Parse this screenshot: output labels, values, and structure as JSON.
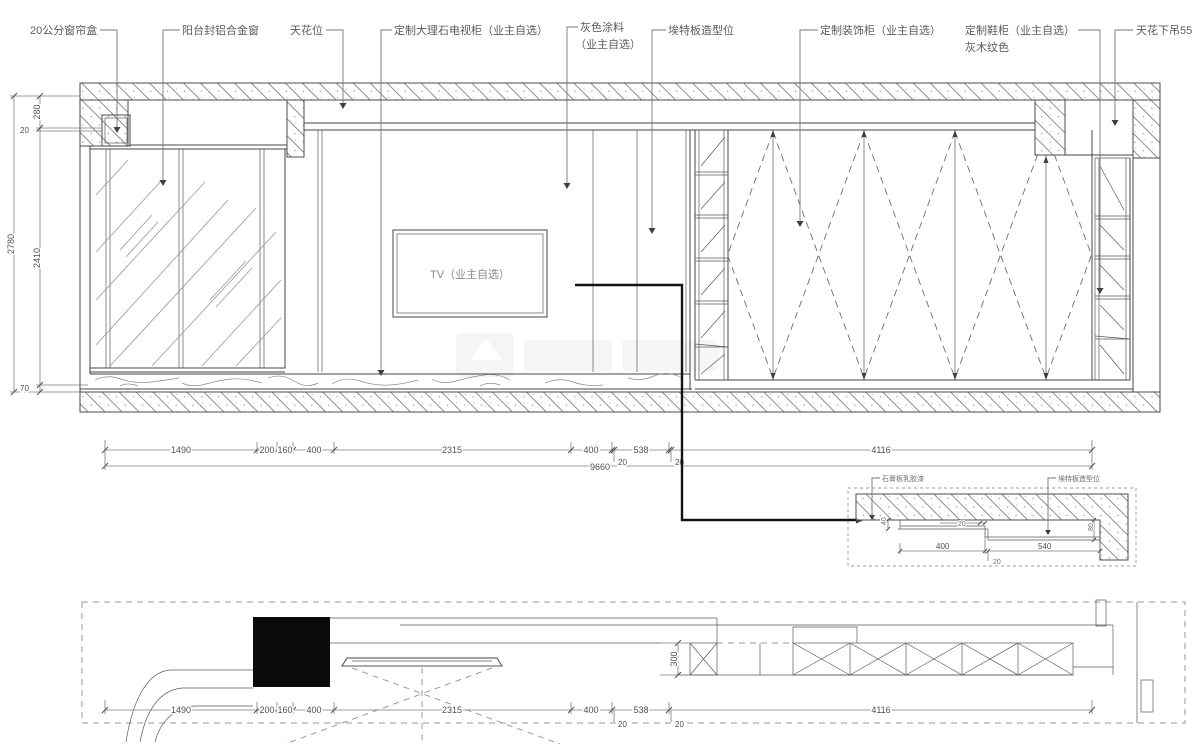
{
  "labels": {
    "curtain_box": "20公分窗帘盒",
    "balcony_window": "阳台封铝合金窗",
    "ceiling_pos": "天花位",
    "tv_cabinet": "定制大理石电视柜（业主自选）",
    "gray_paint_l1": "灰色涂料",
    "gray_paint_l2": "（业主自选）",
    "etex_board": "埃特板造型位",
    "deco_cabinet": "定制装饰柜（业主自选）",
    "shoe_cabinet_l1": "定制鞋柜（业主自选）",
    "shoe_cabinet_l2": "灰木纹色",
    "ceiling_drop": "天花下吊55",
    "tv": "TV（业主自选）"
  },
  "dims": {
    "left": {
      "total": "2780",
      "top": "280",
      "small": "20",
      "mid": "2410",
      "bottom": "70"
    },
    "run": [
      "1490",
      "200",
      "160",
      "400",
      "2315",
      "400",
      "20",
      "538",
      "20",
      "4116"
    ],
    "total": "9660",
    "plan_depth": "300"
  },
  "detail": {
    "leader_left": "石膏板乳胶漆",
    "leader_right": "埃特板造型位",
    "d40": "40",
    "d20a": "20",
    "d80": "80",
    "d400": "400",
    "d20b": "20",
    "d540": "540"
  }
}
